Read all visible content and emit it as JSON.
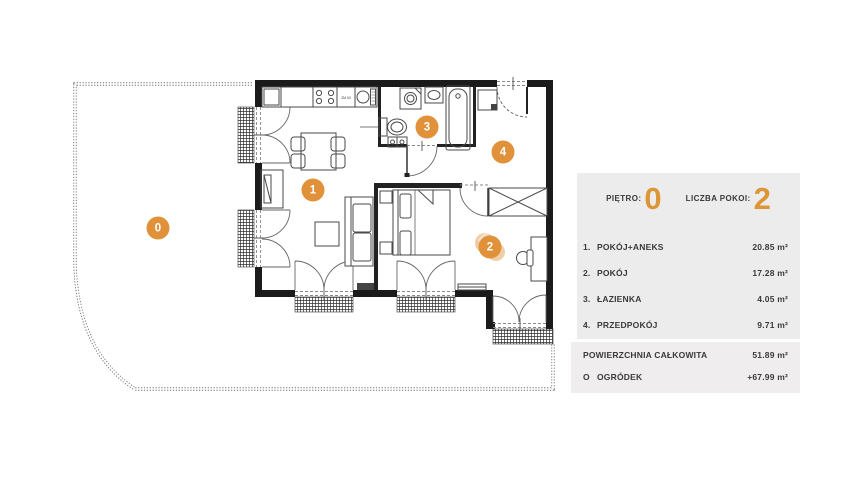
{
  "panel": {
    "floor_label": "PIĘTRO:",
    "floor_value": "0",
    "rooms_label": "LICZBA POKOI:",
    "rooms_value": "2",
    "rows": [
      {
        "num": "1.",
        "name": "POKÓJ+ANEKS",
        "area": "20.85 m²"
      },
      {
        "num": "2.",
        "name": "POKÓJ",
        "area": "17.28 m²"
      },
      {
        "num": "3.",
        "name": "ŁAZIENKA",
        "area": "4.05 m²"
      },
      {
        "num": "4.",
        "name": "PRZEDPOKÓJ",
        "area": "9.71 m²"
      }
    ],
    "summary": [
      {
        "prefix": "",
        "name": "POWIERZCHNIA CAŁKOWITA",
        "area": "51.89 m²"
      },
      {
        "prefix": "O",
        "name": "OGRÓDEK",
        "area": "+67.99 m²"
      }
    ],
    "accent_color": "#DD9537",
    "panel_bg": "#ECECEC",
    "summary_bg": "#EFEDED"
  },
  "plan": {
    "badges": [
      {
        "label": "0"
      },
      {
        "label": "1"
      },
      {
        "label": "2"
      },
      {
        "label": "3"
      },
      {
        "label": "4"
      }
    ],
    "kitchen_label": "ZM 60",
    "badge_color": "#E0913A",
    "wall_color": "#1b1b1b"
  }
}
